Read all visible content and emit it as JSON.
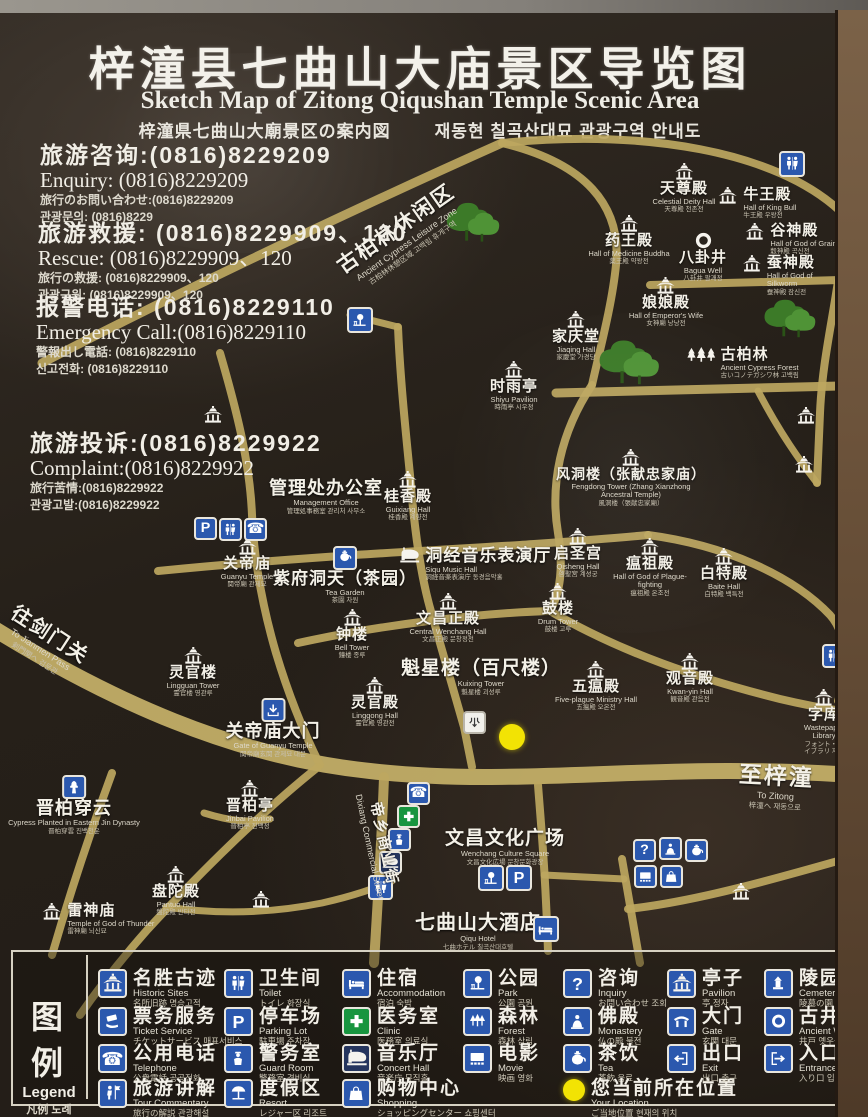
{
  "colors": {
    "road": "#bda75f",
    "road_light": "#c7b269",
    "icon_blue": "#2b58ae",
    "clinic_green": "#18953f",
    "location_yellow": "#f2e304",
    "sign_bg": "#262019",
    "frame_brown": "#6b523a"
  },
  "title": {
    "zh": "梓潼县七曲山大庙景区导览图",
    "en": "Sketch Map of Zitong Qiqushan Temple Scenic Area",
    "jp": "梓潼県七曲山大廟景区の案内図",
    "kr": "재동현 칠곡산대묘 관광구역 안내도"
  },
  "contacts": [
    {
      "zh": "旅游咨询:(0816)8229209",
      "en": "Enquiry: (0816)8229209",
      "jp": "旅行のお問い合わせ:(0816)8229209",
      "kr": "관광문의: (0816)8229"
    },
    {
      "zh": "旅游救援: (0816)8229909、120",
      "en": "Rescue:  (0816)8229909、120",
      "jp": "旅行の救援: (0816)8229909、120",
      "kr": "관광구원: (0816)8229909、120"
    },
    {
      "zh": "报警电话: (0816)8229110",
      "en": "Emergency Call:(0816)8229110",
      "jp": "警報出し電話: (0816)8229110",
      "kr": "신고전화: (0816)8229110"
    },
    {
      "zh": "旅游投诉:(0816)8229922",
      "en": "Complaint:(0816)8229922",
      "jp": "旅行苦情:(0816)8229922",
      "kr": "관광고발:(0816)8229922"
    }
  ],
  "map": {
    "roads": [
      {
        "d": "M-12,612 C110,688 235,744 370,758 C530,776 660,746 880,764",
        "w": 16,
        "c": "#c7b269"
      },
      {
        "d": "M42,350 C200,268 390,180 502,130",
        "w": 9
      },
      {
        "d": "M502,130 C585,150 622,192 616,252 C612,292 600,336 592,372",
        "w": 8
      },
      {
        "d": "M502,130 C645,116 775,138 840,198 C858,218 854,248 842,268",
        "w": 8
      },
      {
        "d": "M650,272 L880,266",
        "w": 8
      },
      {
        "d": "M838,268 C832,310 822,352 820,400 L817,470",
        "w": 8
      },
      {
        "d": "M556,380 L880,372",
        "w": 9
      },
      {
        "d": "M592,372 C560,420 550,472 558,520 C564,556 560,580 550,598",
        "w": 8
      },
      {
        "d": "M220,340 C238,402 250,452 252,502 C254,546 262,592 276,640 C288,680 302,716 320,752",
        "w": 8
      },
      {
        "d": "M398,314 C400,362 405,412 410,462 C414,512 420,562 432,602 C441,634 452,672 464,714 L472,754",
        "w": 8
      },
      {
        "d": "M350,302 L398,314",
        "w": 7
      },
      {
        "d": "M158,558 C300,544 420,538 520,532 C562,529 606,526 648,522",
        "w": 8
      },
      {
        "d": "M298,630 C380,612 480,600 550,598",
        "w": 8
      },
      {
        "d": "M550,598 C622,640 700,666 780,686 C814,694 846,700 880,702",
        "w": 8
      },
      {
        "d": "M648,522 C724,532 792,562 830,602 C848,622 848,658 838,688",
        "w": 8
      },
      {
        "d": "M384,764 C382,822 378,884 374,950",
        "w": 10
      },
      {
        "d": "M538,772 C542,822 546,872 548,938",
        "w": 8
      },
      {
        "d": "M318,754 C258,802 198,862 148,916 C118,950 98,976 80,1002",
        "w": 8
      },
      {
        "d": "M112,760 C90,820 70,880 52,942",
        "w": 8
      },
      {
        "d": "M204,800 C230,808 248,810 270,806",
        "w": 7
      },
      {
        "d": "M166,894 C220,902 272,900 322,890 C362,881 382,872 392,868",
        "w": 7
      },
      {
        "d": "M622,846 C628,882 634,916 640,950",
        "w": 8
      },
      {
        "d": "M628,896 C700,888 782,864 880,836",
        "w": 8
      },
      {
        "d": "M544,862 L624,866",
        "w": 7
      },
      {
        "d": "M758,378 C780,420 800,448 817,470",
        "w": 7
      }
    ],
    "trees": [
      {
        "x": 440,
        "y": 185,
        "s": 62
      },
      {
        "x": 592,
        "y": 322,
        "s": 70
      },
      {
        "x": 758,
        "y": 282,
        "s": 60
      }
    ],
    "pois": [
      {
        "x": 684,
        "y": 150,
        "icon": "temple",
        "zh": "天尊殿",
        "en": "Celestial Deity Hall",
        "jk": "天尊殿 천존전"
      },
      {
        "x": 716,
        "y": 174,
        "icon": "temple",
        "lay": "r",
        "zh": "牛王殿",
        "en": "Hall of King Bull",
        "jk": "牛王殿 우왕전"
      },
      {
        "x": 629,
        "y": 202,
        "icon": "temple",
        "zh": "药王殿",
        "en": "Hall of Medicine Buddha",
        "jk": "薬王殿 약왕전",
        "w": 88
      },
      {
        "x": 703,
        "y": 218,
        "icon": "ring",
        "zh": "八卦井",
        "en": "Bagua Well",
        "jk": "八卦井 팔괘정"
      },
      {
        "x": 743,
        "y": 210,
        "icon": "temple",
        "lay": "r",
        "zh": "谷神殿",
        "en": "Hall of God of Grain",
        "jk": "穀神殿 곡신전"
      },
      {
        "x": 741,
        "y": 242,
        "icon": "temple",
        "lay": "r",
        "zh": "蚕神殿",
        "en": "Hall of God of Silkworm",
        "jk": "蚕神殿 잠신전"
      },
      {
        "x": 666,
        "y": 264,
        "icon": "temple",
        "zh": "娘娘殿",
        "en": "Hall of Emperor's Wife",
        "jk": "女神廟 낭낭전"
      },
      {
        "x": 576,
        "y": 298,
        "icon": "temple",
        "zh": "家庆堂",
        "en": "Jiaqing Hall",
        "jk": "家慶堂 가경당"
      },
      {
        "x": 514,
        "y": 348,
        "icon": "temple",
        "zh": "时雨亭",
        "en": "Shiyu Pavilion",
        "jk": "時雨亭 시우정"
      },
      {
        "x": 686,
        "y": 334,
        "icon": "trees3",
        "lay": "r",
        "zh": "古柏林",
        "en": "Ancient Cypress Forest",
        "jk": "古いコノテガシワ林 고백림"
      },
      {
        "x": 631,
        "y": 436,
        "icon": "temple",
        "zh": "风洞楼（张献忠家庙）",
        "en": "Fengdong Tower (Zhang Xianzhong Ancestral Temple)",
        "jk": "風洞楼（張献忠家廟）",
        "w": 150,
        "zs": 14
      },
      {
        "x": 326,
        "y": 466,
        "zh": "管理处办公室",
        "en": "Management Office",
        "jk": "管理処事務室 관리처 사무소",
        "zs": 18
      },
      {
        "x": 408,
        "y": 458,
        "icon": "temple",
        "zh": "桂香殿",
        "en": "Guixiang Hall",
        "jk": "桂香殿 계향전"
      },
      {
        "x": 247,
        "y": 525,
        "icon": "temple",
        "zh": "关帝庙",
        "en": "Guanyu Temple",
        "jk": "関帝廟 관제묘"
      },
      {
        "x": 345,
        "y": 533,
        "icon": "teabox",
        "zh": "紫府洞天（茶园）",
        "en": "Tea Garden",
        "jk": "茶園 차원",
        "zs": 17
      },
      {
        "x": 398,
        "y": 534,
        "icon": "piano",
        "lay": "r",
        "zh": "洞经音乐表演厅",
        "en": "Siqu Music Hall",
        "jk": "洞経音楽表演庁 동경음악홀",
        "zs": 17
      },
      {
        "x": 578,
        "y": 515,
        "icon": "temple",
        "zh": "启圣宫",
        "en": "Qisheng Hall",
        "jk": "啓聖宮 계성궁"
      },
      {
        "x": 650,
        "y": 525,
        "icon": "temple",
        "zh": "瘟祖殿",
        "en": "Hall of God of Plague-fighting",
        "jk": "瘟祖殿 온조전",
        "w": 88
      },
      {
        "x": 724,
        "y": 535,
        "icon": "temple",
        "zh": "白特殿",
        "en": "Baite Hall",
        "jk": "白特殿 백특전"
      },
      {
        "x": 558,
        "y": 570,
        "icon": "temple",
        "zh": "鼓楼",
        "en": "Drum Tower",
        "jk": "鼓楼 고루"
      },
      {
        "x": 352,
        "y": 596,
        "icon": "temple",
        "zh": "钟楼",
        "en": "Bell Tower",
        "jk": "鐘楼 종루"
      },
      {
        "x": 448,
        "y": 580,
        "icon": "temple",
        "zh": "文昌正殿",
        "en": "Central Wenchang Hall",
        "jk": "文昌正殿 문창정전"
      },
      {
        "x": 481,
        "y": 646,
        "zh": "魁星楼（百尺楼）",
        "en": "Kuixing Tower",
        "jk": "魁星楼 괴성루",
        "zs": 19
      },
      {
        "x": 375,
        "y": 664,
        "icon": "temple",
        "zh": "灵官殿",
        "en": "Linggong Hall",
        "jk": "霊官殿 영관전"
      },
      {
        "x": 596,
        "y": 648,
        "icon": "temple",
        "zh": "五瘟殿",
        "en": "Five-plague Ministry Hall",
        "jk": "五瘟殿 오온전",
        "w": 95
      },
      {
        "x": 690,
        "y": 640,
        "icon": "temple",
        "zh": "观音殿",
        "en": "Kwan-yin Hall",
        "jk": "観音殿 관음전"
      },
      {
        "x": 824,
        "y": 676,
        "icon": "temple",
        "zh": "字库",
        "en": "Wastepaper Library",
        "jk": "フォント・ライブラリ 자고",
        "w": 72
      },
      {
        "x": 193,
        "y": 634,
        "icon": "temple",
        "zh": "灵官楼",
        "en": "Lingguan Tower",
        "jk": "霊官楼 영관루"
      },
      {
        "x": 273,
        "y": 685,
        "icon": "arrdown",
        "zh": "关帝庙大门",
        "en": "Gate of Guanyu Temple",
        "jk": "関帝廟玄関 관제묘 대문",
        "zs": 18
      },
      {
        "x": 74,
        "y": 762,
        "icon": "cypress",
        "zh": "晋柏穿云",
        "en": "Cypress Planted in Eastern Jin Dynasty",
        "jk": "晋柏穿雲 진백천운",
        "zs": 18
      },
      {
        "x": 250,
        "y": 767,
        "icon": "temple",
        "zh": "晋柏亭",
        "en": "Jinbai Pavilion",
        "jk": "晋柏亭 진백정"
      },
      {
        "x": 176,
        "y": 853,
        "icon": "temple",
        "zh": "盘陀殿",
        "en": "Pantuo Hall",
        "jk": "盤陀殿 반타전"
      },
      {
        "x": 40,
        "y": 890,
        "icon": "temple",
        "lay": "r",
        "zh": "雷神庙",
        "en": "Temple of God of Thunder",
        "jk": "雷神廟 뇌신묘"
      },
      {
        "x": 505,
        "y": 816,
        "zh": "文昌文化广场",
        "en": "Wenchang Culture Square",
        "jk": "文昌文化広場 문창문화광장",
        "zs": 19
      },
      {
        "x": 478,
        "y": 900,
        "zh": "七曲山大酒店",
        "en": "Qiqu Hotel",
        "jk": "七曲ホテル 칠곡산대호텔",
        "zs": 20
      },
      {
        "x": 741,
        "y": 870,
        "icon": "temple"
      },
      {
        "x": 261,
        "y": 878,
        "icon": "temple"
      },
      {
        "x": 806,
        "y": 394,
        "icon": "temple"
      },
      {
        "x": 804,
        "y": 443,
        "icon": "temple"
      },
      {
        "x": 213,
        "y": 393,
        "icon": "temple"
      }
    ],
    "badges": [
      {
        "n": "wc",
        "x": 779,
        "y": 138,
        "s": 26
      },
      {
        "n": "park",
        "x": 347,
        "y": 294,
        "s": 26
      },
      {
        "n": "parking",
        "x": 194,
        "y": 504,
        "s": 23
      },
      {
        "n": "wc",
        "x": 219,
        "y": 505,
        "s": 23
      },
      {
        "n": "phone",
        "x": 244,
        "y": 505,
        "s": 23
      },
      {
        "n": "wc",
        "x": 822,
        "y": 631,
        "s": 24
      },
      {
        "n": "phone",
        "x": 407,
        "y": 769,
        "s": 23
      },
      {
        "n": "clinic",
        "x": 397,
        "y": 792,
        "s": 23
      },
      {
        "n": "guard",
        "x": 388,
        "y": 815,
        "s": 23
      },
      {
        "n": "concert",
        "x": 379,
        "y": 838,
        "s": 23
      },
      {
        "n": "wc",
        "x": 368,
        "y": 862,
        "s": 25
      },
      {
        "n": "park",
        "x": 478,
        "y": 852,
        "s": 26
      },
      {
        "n": "parking",
        "x": 506,
        "y": 852,
        "s": 26
      },
      {
        "n": "question",
        "x": 633,
        "y": 826,
        "s": 23
      },
      {
        "n": "buddha",
        "x": 659,
        "y": 824,
        "s": 23
      },
      {
        "n": "tea",
        "x": 685,
        "y": 826,
        "s": 23
      },
      {
        "n": "movie",
        "x": 634,
        "y": 852,
        "s": 23
      },
      {
        "n": "shopping",
        "x": 660,
        "y": 852,
        "s": 23
      },
      {
        "n": "bed",
        "x": 533,
        "y": 903,
        "s": 26
      },
      {
        "n": "junction",
        "x": 463,
        "y": 698,
        "s": 23
      }
    ],
    "location_dot": {
      "x": 499,
      "y": 711,
      "s": 26,
      "label": "current location"
    },
    "rlabels": [
      {
        "x": 330,
        "y": 242,
        "rot": -35,
        "zh": "古柏林休闲区",
        "en": "Ancient Cypress Leisure Zone",
        "jk": "古柏林休憩区域 고백림 휴게구역",
        "zs": 21
      },
      {
        "x": 22,
        "y": 584,
        "rot": 33,
        "zh": "往剑门关",
        "en": "To Jianmen Pass",
        "jk": "剣門関へ 검문관",
        "zs": 20
      },
      {
        "x": 384,
        "y": 776,
        "rot": 78,
        "zh": "帝乡商业街",
        "en": "Dixiang Commercial Street",
        "jk": "",
        "zs": 15
      },
      {
        "x": 740,
        "y": 742,
        "rot": 3,
        "zh": "至梓潼",
        "en": "To Zitong",
        "jk": "梓潼へ 재동으로",
        "zs": 23
      }
    ]
  },
  "legend": {
    "title": {
      "zh": "图 例",
      "en": "Legend",
      "jk": "凡例  도례"
    },
    "items": [
      {
        "col": "A",
        "row": 1,
        "icon": "temple",
        "zh": "名胜古迹",
        "en": "Historic Sites",
        "jk": "名所旧跡 명승고적"
      },
      {
        "col": "A",
        "row": 2,
        "icon": "ticket",
        "zh": "票务服务",
        "en": "Ticket Service",
        "jk": "チケットサービス 매표서비스"
      },
      {
        "col": "A",
        "row": 3,
        "icon": "phone",
        "zh": "公用电话",
        "en": "Telephone",
        "jk": "公衆電話 공공전화"
      },
      {
        "col": "A",
        "row": 4,
        "icon": "tour",
        "zh": "旅游讲解",
        "en": "Tour Commentary",
        "jk": "旅行の解説 관광해설"
      },
      {
        "col": "B",
        "row": 1,
        "icon": "wc",
        "zh": "卫生间",
        "en": "Toilet",
        "jk": "トイレ 화장실"
      },
      {
        "col": "B",
        "row": 2,
        "icon": "parking",
        "zh": "停车场",
        "en": "Parking Lot",
        "jk": "駐車場 주차장"
      },
      {
        "col": "B",
        "row": 3,
        "icon": "guard",
        "zh": "警务室",
        "en": "Guard Room",
        "jk": "警務室 경비실"
      },
      {
        "col": "B",
        "row": 4,
        "icon": "resort",
        "zh": "度假区",
        "en": "Resort",
        "jk": "レジャー区 리조트"
      },
      {
        "col": "C",
        "row": 1,
        "icon": "bed",
        "zh": "住宿",
        "en": "Accommodation",
        "jk": "宿泊 숙박"
      },
      {
        "col": "C",
        "row": 2,
        "icon": "clinic",
        "zh": "医务室",
        "en": "Clinic",
        "jk": "医務室 의료실"
      },
      {
        "col": "C",
        "row": 3,
        "icon": "concert",
        "zh": "音乐厅",
        "en": "Concert Hall",
        "jk": "音楽庁 뮤직홀"
      },
      {
        "col": "C",
        "row": 4,
        "icon": "shopping",
        "zh": "购物中心",
        "en": "Shopping",
        "jk": "ショッピングセンター 쇼핑센터"
      },
      {
        "col": "D",
        "row": 1,
        "icon": "park",
        "zh": "公园",
        "en": "Park",
        "jk": "公園 공원"
      },
      {
        "col": "D",
        "row": 2,
        "icon": "forest",
        "zh": "森林",
        "en": "Forest",
        "jk": "森林 삼림"
      },
      {
        "col": "D",
        "row": 3,
        "icon": "movie",
        "zh": "电影",
        "en": "Movie",
        "jk": "映画 영화"
      },
      {
        "col": "E",
        "row": 1,
        "icon": "question",
        "zh": "咨询",
        "en": "Inquiry",
        "jk": "お問い合わせ 조회"
      },
      {
        "col": "E",
        "row": 2,
        "icon": "buddha",
        "zh": "佛殿",
        "en": "Monastery",
        "jk": "仏の殿 불전"
      },
      {
        "col": "E",
        "row": 3,
        "icon": "tea",
        "zh": "茶饮",
        "en": "Tea",
        "jk": "茶飲 음료"
      },
      {
        "col": "E",
        "row": 4,
        "icon": "location",
        "zh": "您当前所在位置",
        "en": "Your Location",
        "jk": "ご当地位置 현재의 위치"
      },
      {
        "col": "F",
        "row": 1,
        "icon": "temple",
        "zh": "亭子",
        "en": "Pavilion",
        "jk": "亭 정자"
      },
      {
        "col": "F",
        "row": 2,
        "icon": "gate",
        "zh": "大门",
        "en": "Gate",
        "jk": "玄関 대문"
      },
      {
        "col": "F",
        "row": 3,
        "icon": "exit",
        "zh": "出口",
        "en": "Exit",
        "jk": "出口 출구"
      },
      {
        "col": "G",
        "row": 1,
        "icon": "cemetery",
        "zh": "陵园",
        "en": "Cemetery",
        "jk": "陵墓の園 능원"
      },
      {
        "col": "G",
        "row": 2,
        "icon": "well",
        "zh": "古井",
        "en": "Ancient Well",
        "jk": "井戸 옛우물"
      },
      {
        "col": "G",
        "row": 3,
        "icon": "entrance",
        "zh": "入口",
        "en": "Entrance",
        "jk": "入り口 입구"
      }
    ]
  }
}
